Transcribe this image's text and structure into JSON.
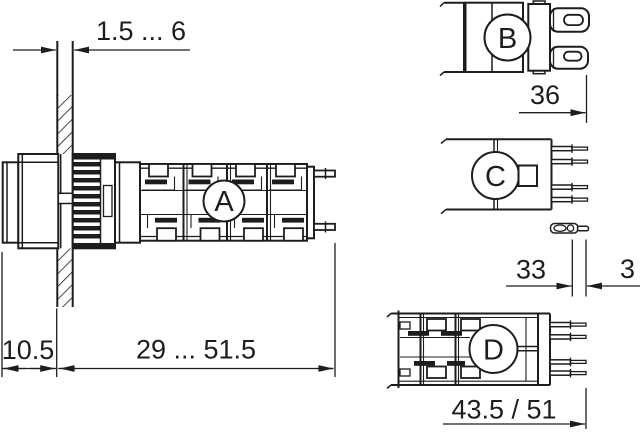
{
  "drawing": {
    "background": "#ffffff",
    "line_color": "#1d1d1b",
    "views": {
      "a": {
        "label": "A"
      },
      "b": {
        "label": "B"
      },
      "c": {
        "label": "C"
      },
      "d": {
        "label": "D"
      }
    },
    "dimensions": {
      "panel_thickness": "1.5 ... 6",
      "front_projection": "10.5",
      "mounting_depth": "29 ... 51.5",
      "width_view_b": "36",
      "length_view_c": "33",
      "terminal_tip": "3",
      "length_view_d": "43.5 / 51"
    }
  }
}
